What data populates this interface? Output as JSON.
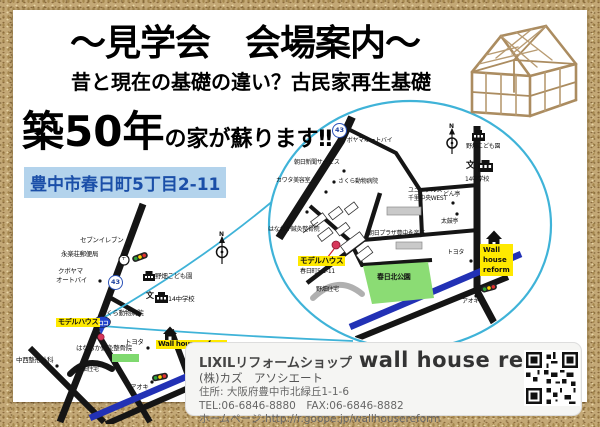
{
  "header": {
    "title": "〜見学会　会場案内〜",
    "subtitle": "昔と現在の基礎の違い？古民家再生基礎",
    "catch_big": "築50年",
    "catch_small": "の家が蘇ります‼",
    "address_highlight": "豊中市春日町5丁目2-11"
  },
  "inset_map": {
    "route_badge": "43",
    "compass_n": "N",
    "labels": {
      "kuboyama": "クボヤマオートバイ",
      "asahi_news": "朝日新聞サービス",
      "kawata": "カワタ美容室",
      "sakura_vet": "さくら動物病院",
      "uni_arsu_1": "ユニ・アルス",
      "uni_arsu_2": "千里中央WEST",
      "asahi_plaza": "朝日プラザ豊中永楽荘",
      "don_tei": "どん亭",
      "taiko_tei": "太鼓亭",
      "toyota": "トヨタ",
      "nobatake_kodomoen": "野畑こども園",
      "school_mark": "文",
      "junior_high": "14中学校",
      "wall_house_1": "Wall",
      "wall_house_2": "house",
      "wall_house_3": "reform",
      "aoki": "アオキ",
      "kasuga_park": "春日北公園",
      "nobatake_jutaku": "野畑住宅",
      "hanaoka": "はなおか鍼灸整骨院",
      "model_house": "モデルハウス",
      "model_house_addr": "春日町5-2-11"
    }
  },
  "left_map": {
    "route_badge": "43",
    "compass_n": "N",
    "labels": {
      "seven_eleven": "セブンイレブン",
      "post_office": "永楽荘郵便局",
      "post_mark": "〒",
      "kuboyama_1": "クボヤマ",
      "kuboyama_2": "オートバイ",
      "nobatake_kodomoen": "野畑こども園",
      "school_mark": "文",
      "junior_high": "14中学校",
      "sakura_vet": "さくら動物病院",
      "model_house": "モデルハウス",
      "here_balloon": "ココ",
      "hanaoka": "はなおか鍼灸整骨院",
      "nakanishi": "中西整形外科",
      "nobatake_jutaku": "野畑住宅",
      "wall_house": "Wall house reform",
      "toyota": "トヨタ",
      "aoki": "アオキ"
    }
  },
  "info_box": {
    "shop_type": "LIXILリフォームショップ",
    "shop_name": "wall house reform",
    "company": "(株)カズ　アソシエート",
    "address": "住所: 大阪府豊中市北緑丘1-1-6",
    "tel_fax": "TEL:06-6846-8880　FAX:06-6846-8882",
    "homepage": "ホームページ:http://r.goope.jp/wallhousereform"
  },
  "colors": {
    "magnifier_blue": "#3fb3d8",
    "road_black": "#151515",
    "road_blue": "#2231b5",
    "park_green": "#7fd96f",
    "highlight_yellow": "#ffe900",
    "address_bg": "#b3d3ec",
    "address_text": "#1b4fa8",
    "border_sand": "#c3a876"
  }
}
